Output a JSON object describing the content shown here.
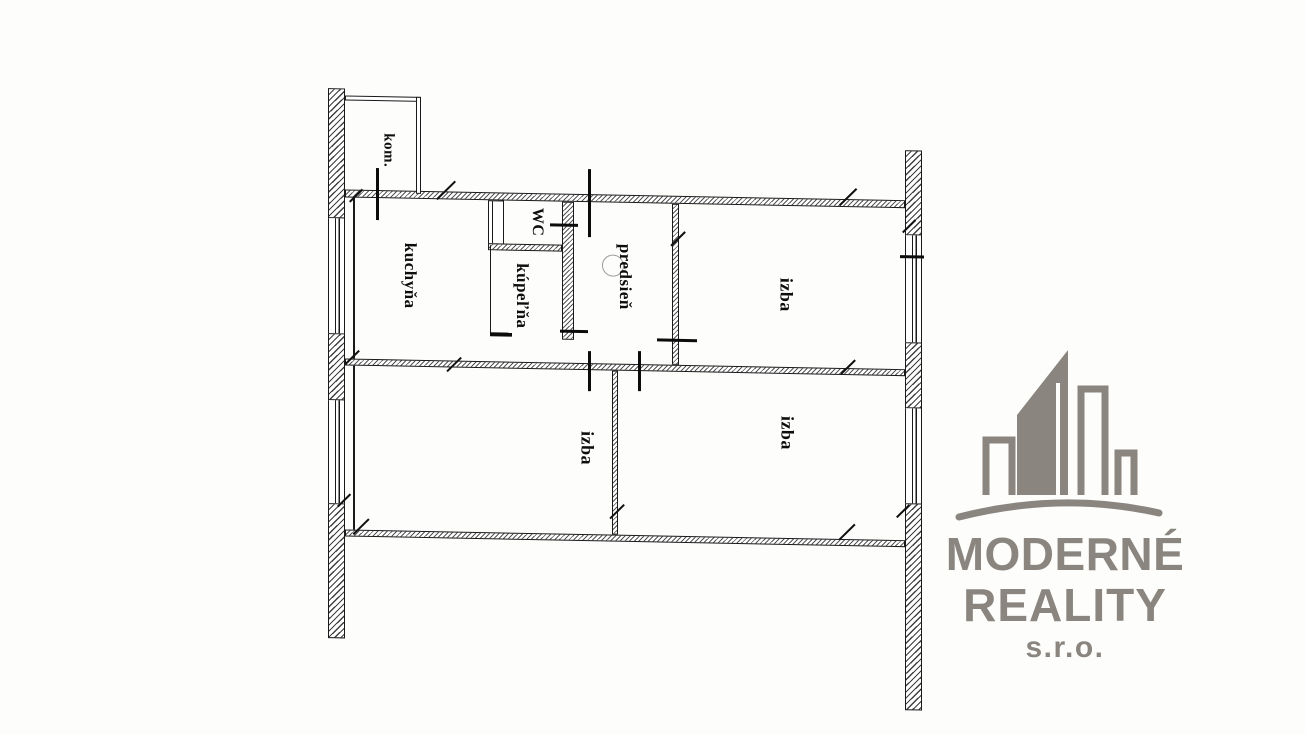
{
  "plan": {
    "rooms": {
      "kom": "kom.",
      "kuchyna": "kuchyňa",
      "wc": "WC",
      "kupelna": "kúpeľňa",
      "predsien": "predsieň",
      "izba_top_right": "izba",
      "izba_bottom_left": "izba",
      "izba_bottom_right": "izba"
    },
    "colors": {
      "line": "#1a1a1a",
      "background": "#fdfdfb"
    }
  },
  "watermark": {
    "name_line1": "MODERNÉ",
    "name_line2": "REALITY",
    "name_line3": "s.r.o.",
    "color": "#8a857f",
    "icon": "buildings-skyline-icon"
  }
}
